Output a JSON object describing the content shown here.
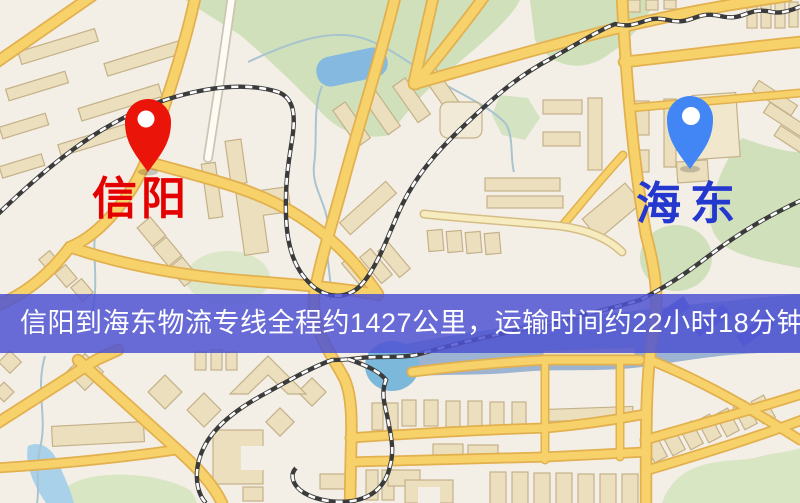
{
  "map": {
    "markers": {
      "origin": {
        "label": "信阳",
        "pin_color": "#ea1408",
        "label_color": "#e50000"
      },
      "destination": {
        "label": "海东",
        "pin_color": "#4285f4",
        "label_color": "#2437ce"
      }
    },
    "banner": {
      "text": "信阳到海东物流专线全程约1427公里，运输时间约22小时18分钟.",
      "background": "#4f54d2",
      "text_color": "#ffffff"
    },
    "route_info": {
      "origin": "信阳",
      "destination": "海东",
      "service_type": "物流专线",
      "distance_text": "约1427公里",
      "duration_text": "约22小时18分钟"
    },
    "theme": {
      "land": "#f4efe6",
      "park": "#cfe0ba",
      "water_river": "#9cb3d2",
      "water_lake": "#85b9e0",
      "road": "#f7d26b",
      "road_casing": "#e2b04f",
      "railway": "#3b3b3b",
      "building": "#ebdfbd"
    }
  }
}
